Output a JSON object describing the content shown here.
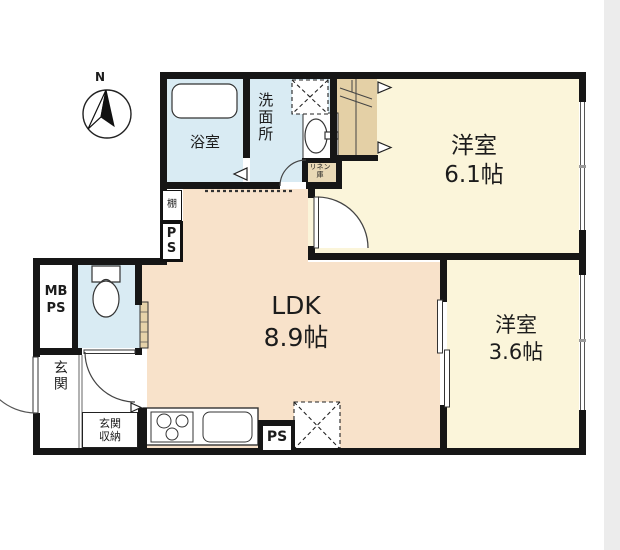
{
  "title": "apartment-floor-plan",
  "compass": {
    "north_label": "N"
  },
  "rooms": {
    "bedroom1": {
      "label": "洋室\n6.1帖",
      "name": "洋室",
      "size": "6.1帖"
    },
    "bedroom2": {
      "label": "洋室\n3.6帖",
      "name": "洋室",
      "size": "3.6帖"
    },
    "ldk": {
      "label": "LDK\n8.9帖",
      "name": "LDK",
      "size": "8.9帖"
    },
    "bathroom": {
      "label": "浴室"
    },
    "washroom": {
      "label": "洗面所"
    },
    "entrance": {
      "label": "玄関"
    },
    "entrance_storage": {
      "label": "玄関\n収納"
    },
    "linen_closet": {
      "label": "リネン\n庫"
    },
    "shelf": {
      "label": "棚"
    },
    "meter_box": {
      "label": "MB\nPS"
    },
    "pipe_space_upper": {
      "label": "P\nS"
    },
    "pipe_space_lower": {
      "label": "PS"
    }
  },
  "colors": {
    "wall": "#161616",
    "ldk_floor": "#f8e2ca",
    "bedroom_floor": "#fbf5da",
    "wet_area_floor": "#d9ebf3",
    "closet": "#e4d0a6",
    "linen": "#e9d9b6",
    "page_edge": "#ececec"
  }
}
